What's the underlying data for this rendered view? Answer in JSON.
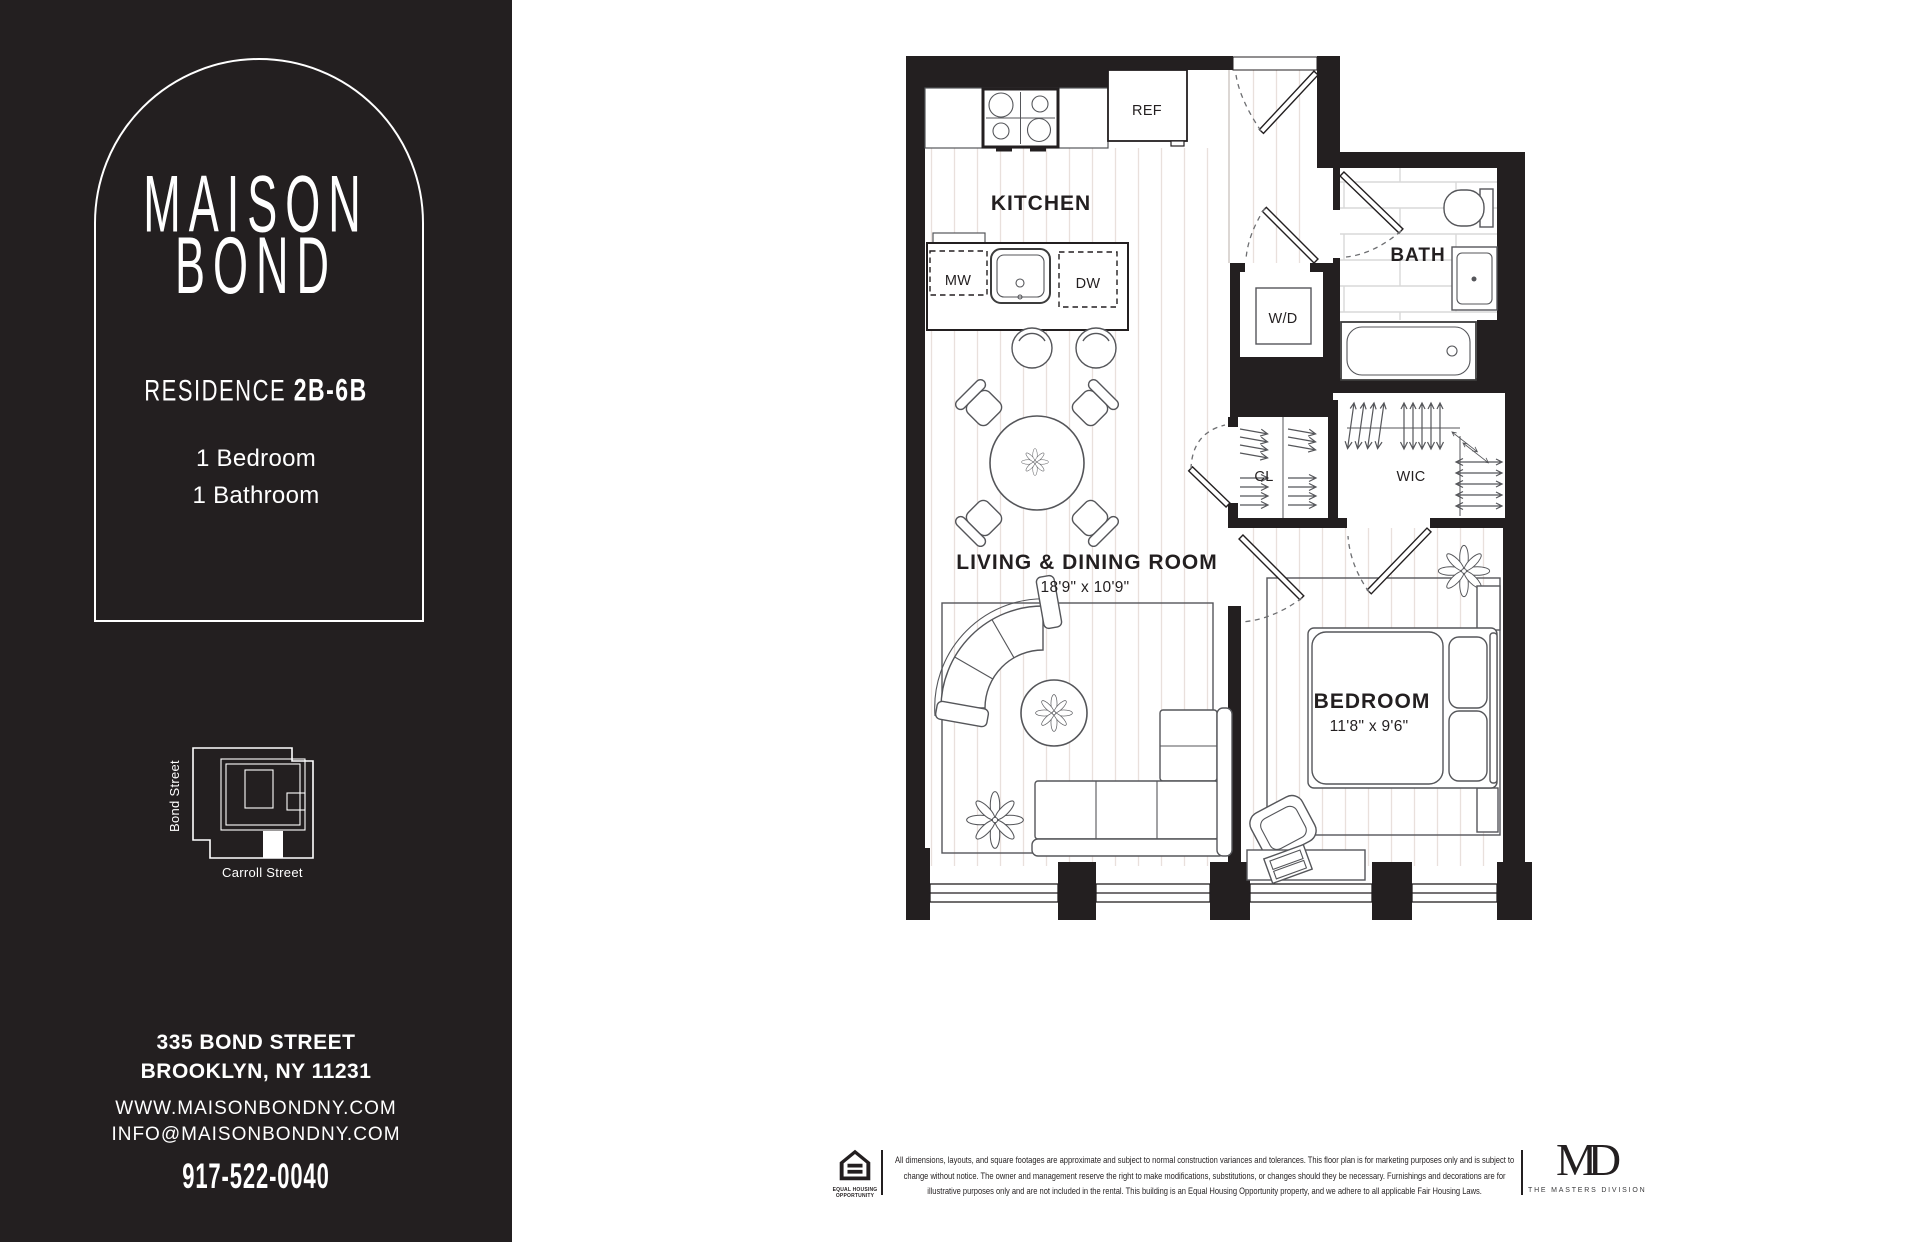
{
  "sidebar": {
    "logo_line1": "MAISON",
    "logo_line2": "BOND",
    "residence_label": "RESIDENCE",
    "residence_number": "2B-6B",
    "bedroom_line": "1 Bedroom",
    "bathroom_line": "1 Bathroom",
    "site_map": {
      "street_left": "Bond Street",
      "street_bottom": "Carroll Street"
    },
    "address_line1": "335 BOND STREET",
    "address_line2": "BROOKLYN, NY 11231",
    "website": "WWW.MAISONBONDNY.COM",
    "email": "INFO@MAISONBONDNY.COM",
    "phone": "917-522-0040"
  },
  "floorplan": {
    "rooms": {
      "kitchen": {
        "label": "KITCHEN"
      },
      "living": {
        "label": "LIVING & DINING ROOM",
        "dimensions": "18'9\" x 10'9\""
      },
      "bedroom": {
        "label": "BEDROOM",
        "dimensions": "11'8\" x 9'6\""
      },
      "bath": {
        "label": "BATH"
      },
      "wic": {
        "label": "WIC"
      },
      "cl": {
        "label": "CL"
      },
      "wd": {
        "label": "W/D"
      }
    },
    "appliances": {
      "ref": "REF",
      "mw": "MW",
      "dw": "DW"
    }
  },
  "footer": {
    "eho_caption": "EQUAL HOUSING OPPORTUNITY",
    "disclaimer": "All dimensions, layouts, and square footages are approximate and subject to normal construction variances and tolerances. This floor plan is for marketing purposes only and is subject to change without notice. The owner and management reserve the right to make modifications, substitutions, or changes should they be necessary. Furnishings and decorations are for illustrative purposes only and are not included in the rental. This building is an Equal Housing Opportunity property, and we adhere to all applicable Fair Housing Laws.",
    "masters_monogram": "MD",
    "masters_caption": "THE MASTERS DIVISION"
  },
  "colors": {
    "ink": "#231f20",
    "plank_line": "#e9e0dc",
    "tile_line": "#d8d8d8",
    "furniture_line": "#55565a"
  }
}
